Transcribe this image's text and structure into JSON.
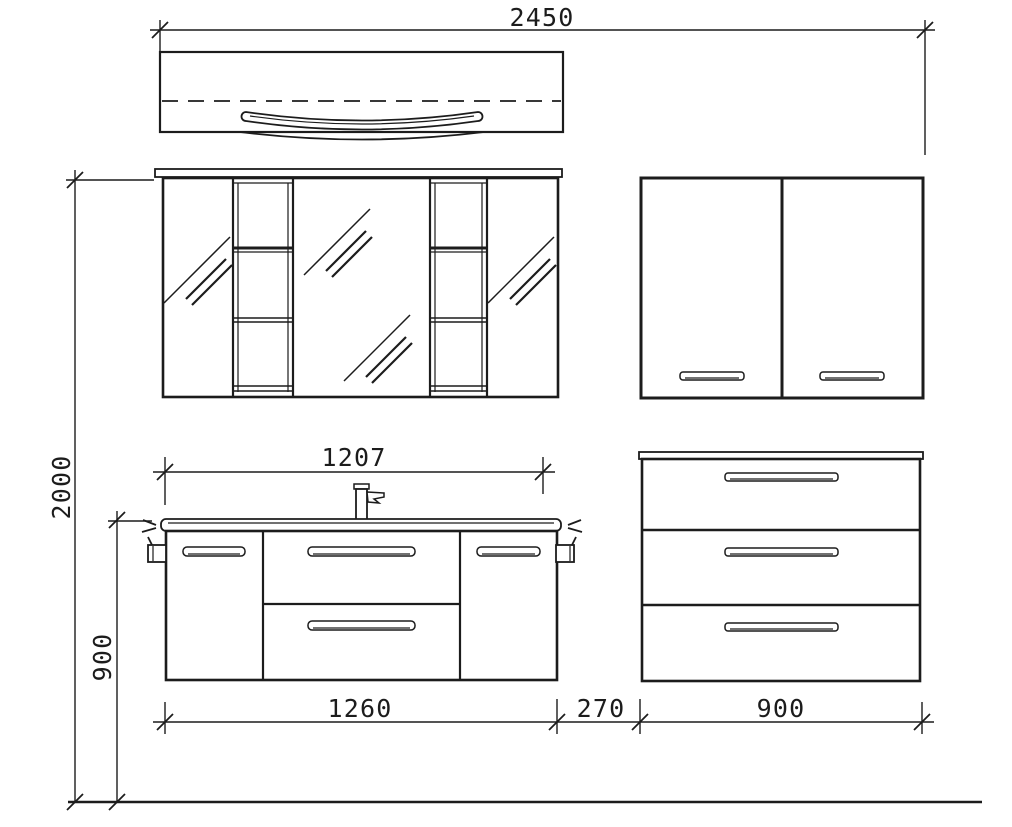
{
  "colors": {
    "background": "#ffffff",
    "line": "#1c1c1c"
  },
  "dimensions": {
    "total_width": "2450",
    "total_height": "2000",
    "vanity_height": "900",
    "washbasin_width": "1207",
    "vanity_width": "1260",
    "spacer_width": "270",
    "side_cabinet_width": "900"
  }
}
